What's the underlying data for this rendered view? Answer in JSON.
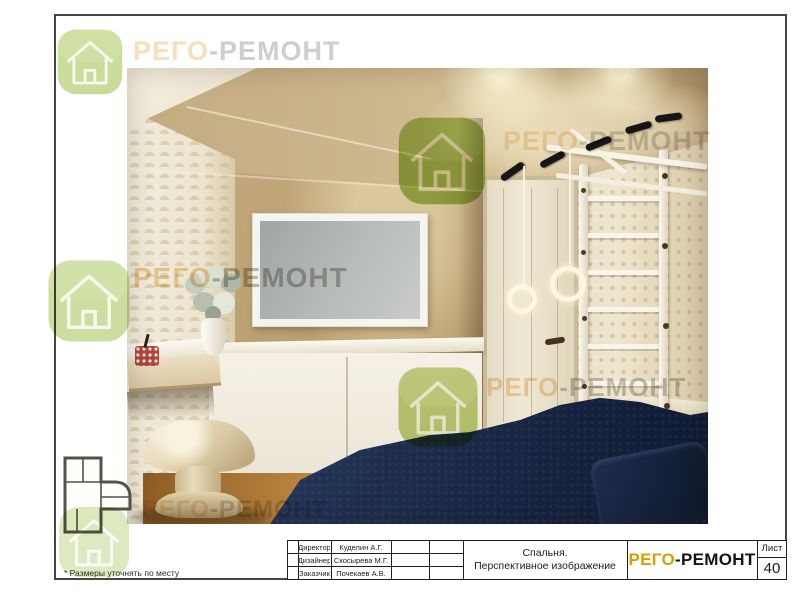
{
  "sheet": {
    "footnote": "* Размеры уточнять по месту",
    "watermark": {
      "part1": "РЕГО",
      "part2": "-РЕМОНТ"
    },
    "titleblock": {
      "rows": [
        {
          "label": "Директор",
          "value": "Куделин А.Г."
        },
        {
          "label": "Дизайнер",
          "value": "Скосырева М.Г."
        },
        {
          "label": "Заказчик",
          "value": "Почекаев А.В."
        }
      ],
      "title_line1": "Спальня.",
      "title_line2": "Перспективное изображение",
      "logo": {
        "part1": "РЕГО",
        "part2": "-РЕМОНТ"
      },
      "sheet_label": "Лист",
      "sheet_number": "40"
    },
    "colors": {
      "logo_orange": "#e09b00",
      "logo_black": "#141414",
      "watermark_green": "#9dbf48",
      "bed_navy": "#1a2947"
    }
  }
}
